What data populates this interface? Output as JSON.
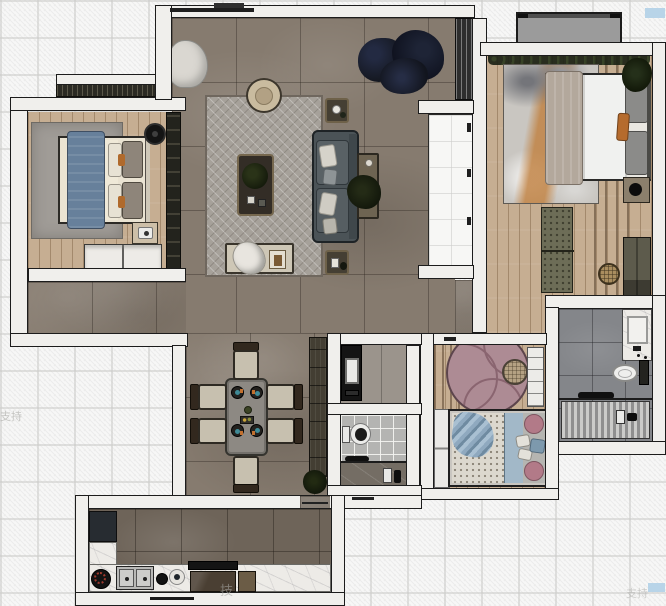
{
  "watermarks": {
    "left": "支持",
    "bottom": "技",
    "corner": "支持"
  },
  "palette": {
    "background": "#f7f7f6",
    "wall": "#f0efec",
    "wall_outline": "#1c1c1c",
    "stone_floor": "#867b6f",
    "kitchen_floor": "#6e6459",
    "wood_floor": "#c6ae92",
    "living_rug": "#a6a19a",
    "bed_blue_throw": "#67809b",
    "bed_cream": "#eae3d2",
    "kids_rug_pink": "#ad8b94",
    "kids_blue": "#9fb6c6",
    "accent_orange": "#b06a2c",
    "sofa_gray": "#4b5357",
    "bath_tile": "#84868a",
    "marble_counter": "#edebe7",
    "balcony_gray": "#9b9b9b",
    "watermark_blue_chip": "#b8d4e8"
  },
  "plan": {
    "type": "apartment-floor-plan-top-view",
    "rooms": [
      {
        "id": "living-room",
        "furniture": [
          "herringbone-rug",
          "sofa",
          "coffee-table",
          "armchair",
          "side-tables",
          "console",
          "bench",
          "large-plant",
          "curtain"
        ]
      },
      {
        "id": "bedroom-top-left",
        "furniture": [
          "double-bed",
          "blue-throw",
          "area-rug",
          "wardrobe",
          "closet",
          "nightstand",
          "dresser",
          "ceiling-fan"
        ]
      },
      {
        "id": "bedroom-top-right",
        "furniture": [
          "double-bed",
          "abstract-rug",
          "bench",
          "wardrobe",
          "nightstand",
          "rattan-pouf",
          "plants",
          "balcony"
        ]
      },
      {
        "id": "dining-area",
        "furniture": [
          "dining-table",
          "six-chairs",
          "tall-cabinet",
          "plant"
        ]
      },
      {
        "id": "kids-bedroom",
        "furniture": [
          "bed",
          "round-pink-rug",
          "pouf",
          "shelf-cabinet",
          "wardrobe"
        ]
      },
      {
        "id": "bathroom-middle",
        "furniture": [
          "black-vanity",
          "sink",
          "toilet",
          "shower"
        ]
      },
      {
        "id": "bathroom-right",
        "furniture": [
          "vanity-sink",
          "toilet",
          "shower-striped-floor"
        ]
      },
      {
        "id": "kitchen",
        "furniture": [
          "fridge",
          "double-sink",
          "round-burner",
          "plate",
          "cooktop-hood",
          "cabinets",
          "marble-counter"
        ]
      }
    ]
  }
}
